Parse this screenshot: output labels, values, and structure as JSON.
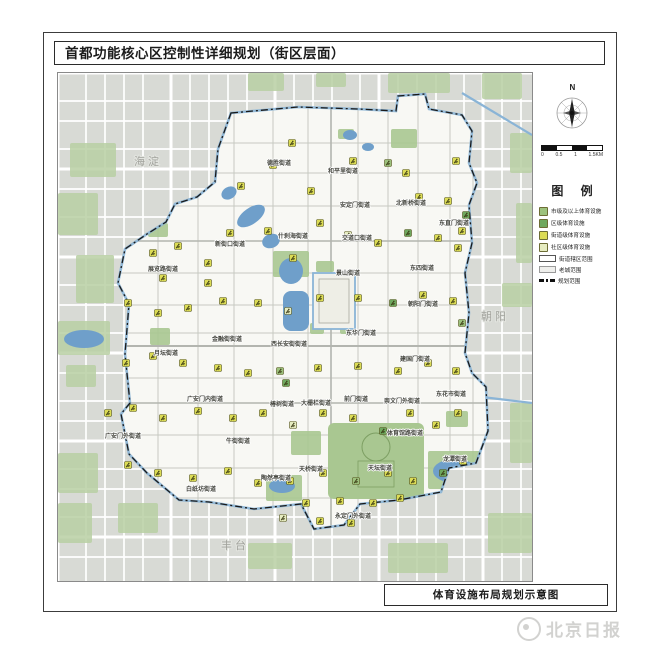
{
  "page": {
    "title": "首都功能核心区控制性详细规划（街区层面）",
    "caption": "体育设施布局规划示意图",
    "watermark": "北京日报"
  },
  "compass": {
    "label": "N"
  },
  "scalebar": {
    "ticks": [
      "0",
      "0.5",
      "1",
      "1.5KM"
    ]
  },
  "legend": {
    "title": "图 例",
    "items": [
      {
        "type": "facility",
        "level": "1",
        "color": "#9dc27d",
        "label": "市级及以上体育设施"
      },
      {
        "type": "facility",
        "level": "2",
        "color": "#6fa85e",
        "label": "区级体育设施"
      },
      {
        "type": "facility",
        "level": "3",
        "color": "#dcdc55",
        "label": "街道级体育设施"
      },
      {
        "type": "facility",
        "level": "4",
        "color": "#e6ecc0",
        "label": "社区级体育设施"
      },
      {
        "type": "rect",
        "label": "街道辖区范围"
      },
      {
        "type": "rect2",
        "label": "老城范围"
      },
      {
        "type": "dash",
        "label": "规划范围"
      }
    ]
  },
  "map": {
    "colors": {
      "level1": "#9dc27d",
      "level2": "#6fa85e",
      "level3": "#dcdc55",
      "level4": "#e6ecc0",
      "water": "#6f9fca",
      "waterline": "#8ab4d6",
      "park": "#a9c791",
      "outside_park": "#b9cfa3",
      "boundary": "#1a1a1a",
      "core_fill": "#f8f8f4"
    },
    "district_labels": [
      {
        "text": "海淀",
        "x": 90,
        "y": 92
      },
      {
        "text": "朝阳",
        "x": 437,
        "y": 247
      },
      {
        "text": "丰台",
        "x": 177,
        "y": 476
      }
    ],
    "street_labels": [
      {
        "text": "德胜街道",
        "x": 221,
        "y": 92
      },
      {
        "text": "和平里街道",
        "x": 285,
        "y": 100
      },
      {
        "text": "安定门街道",
        "x": 297,
        "y": 134
      },
      {
        "text": "北新桥街道",
        "x": 353,
        "y": 132
      },
      {
        "text": "东直门街道",
        "x": 396,
        "y": 152
      },
      {
        "text": "什刹海街道",
        "x": 235,
        "y": 165
      },
      {
        "text": "交道口街道",
        "x": 299,
        "y": 167
      },
      {
        "text": "新街口街道",
        "x": 172,
        "y": 173
      },
      {
        "text": "展览路街道",
        "x": 105,
        "y": 198
      },
      {
        "text": "景山街道",
        "x": 290,
        "y": 202
      },
      {
        "text": "东四街道",
        "x": 364,
        "y": 197
      },
      {
        "text": "朝阳门街道",
        "x": 365,
        "y": 233
      },
      {
        "text": "东华门街道",
        "x": 303,
        "y": 262
      },
      {
        "text": "建国门街道",
        "x": 357,
        "y": 288
      },
      {
        "text": "金融街街道",
        "x": 169,
        "y": 268
      },
      {
        "text": "月坛街道",
        "x": 108,
        "y": 282
      },
      {
        "text": "西长安街街道",
        "x": 231,
        "y": 273
      },
      {
        "text": "广安门内街道",
        "x": 147,
        "y": 328
      },
      {
        "text": "椿树街道",
        "x": 224,
        "y": 333
      },
      {
        "text": "大栅栏街道",
        "x": 258,
        "y": 332
      },
      {
        "text": "前门街道",
        "x": 298,
        "y": 328
      },
      {
        "text": "崇文门外街道",
        "x": 344,
        "y": 330
      },
      {
        "text": "东花市街道",
        "x": 393,
        "y": 323
      },
      {
        "text": "广安门外街道",
        "x": 65,
        "y": 365
      },
      {
        "text": "牛街街道",
        "x": 180,
        "y": 370
      },
      {
        "text": "体育馆路街道",
        "x": 347,
        "y": 362
      },
      {
        "text": "龙潭街道",
        "x": 397,
        "y": 388
      },
      {
        "text": "陶然亭街道",
        "x": 218,
        "y": 407
      },
      {
        "text": "白纸坊街道",
        "x": 143,
        "y": 418
      },
      {
        "text": "天桥街道",
        "x": 253,
        "y": 398
      },
      {
        "text": "天坛街道",
        "x": 322,
        "y": 397
      },
      {
        "text": "永定门外街道",
        "x": 295,
        "y": 445
      }
    ],
    "facilities": [
      {
        "x": 234,
        "y": 70,
        "l": 3
      },
      {
        "x": 215,
        "y": 92,
        "l": 3
      },
      {
        "x": 295,
        "y": 88,
        "l": 3
      },
      {
        "x": 330,
        "y": 90,
        "l": 1
      },
      {
        "x": 348,
        "y": 100,
        "l": 3
      },
      {
        "x": 398,
        "y": 88,
        "l": 3
      },
      {
        "x": 390,
        "y": 128,
        "l": 3
      },
      {
        "x": 361,
        "y": 124,
        "l": 3
      },
      {
        "x": 183,
        "y": 113,
        "l": 3
      },
      {
        "x": 253,
        "y": 118,
        "l": 3
      },
      {
        "x": 408,
        "y": 142,
        "l": 2
      },
      {
        "x": 404,
        "y": 158,
        "l": 3
      },
      {
        "x": 95,
        "y": 180,
        "l": 3
      },
      {
        "x": 120,
        "y": 173,
        "l": 3
      },
      {
        "x": 150,
        "y": 190,
        "l": 3
      },
      {
        "x": 172,
        "y": 160,
        "l": 3
      },
      {
        "x": 210,
        "y": 158,
        "l": 3
      },
      {
        "x": 235,
        "y": 185,
        "l": 3
      },
      {
        "x": 262,
        "y": 150,
        "l": 3
      },
      {
        "x": 290,
        "y": 162,
        "l": 4
      },
      {
        "x": 320,
        "y": 170,
        "l": 3
      },
      {
        "x": 350,
        "y": 160,
        "l": 2
      },
      {
        "x": 380,
        "y": 165,
        "l": 3
      },
      {
        "x": 400,
        "y": 175,
        "l": 3
      },
      {
        "x": 150,
        "y": 210,
        "l": 3
      },
      {
        "x": 105,
        "y": 205,
        "l": 3
      },
      {
        "x": 70,
        "y": 230,
        "l": 3
      },
      {
        "x": 100,
        "y": 240,
        "l": 3
      },
      {
        "x": 130,
        "y": 235,
        "l": 3
      },
      {
        "x": 165,
        "y": 228,
        "l": 3
      },
      {
        "x": 200,
        "y": 230,
        "l": 3
      },
      {
        "x": 230,
        "y": 238,
        "l": 4
      },
      {
        "x": 262,
        "y": 225,
        "l": 3
      },
      {
        "x": 300,
        "y": 225,
        "l": 3
      },
      {
        "x": 335,
        "y": 230,
        "l": 2
      },
      {
        "x": 365,
        "y": 222,
        "l": 3
      },
      {
        "x": 395,
        "y": 228,
        "l": 3
      },
      {
        "x": 404,
        "y": 250,
        "l": 1
      },
      {
        "x": 68,
        "y": 290,
        "l": 3
      },
      {
        "x": 95,
        "y": 283,
        "l": 3
      },
      {
        "x": 125,
        "y": 290,
        "l": 3
      },
      {
        "x": 160,
        "y": 295,
        "l": 3
      },
      {
        "x": 190,
        "y": 300,
        "l": 3
      },
      {
        "x": 222,
        "y": 298,
        "l": 1
      },
      {
        "x": 228,
        "y": 310,
        "l": 2
      },
      {
        "x": 260,
        "y": 295,
        "l": 3
      },
      {
        "x": 300,
        "y": 293,
        "l": 3
      },
      {
        "x": 340,
        "y": 298,
        "l": 3
      },
      {
        "x": 370,
        "y": 290,
        "l": 3
      },
      {
        "x": 398,
        "y": 298,
        "l": 3
      },
      {
        "x": 50,
        "y": 340,
        "l": 3
      },
      {
        "x": 75,
        "y": 335,
        "l": 3
      },
      {
        "x": 105,
        "y": 345,
        "l": 3
      },
      {
        "x": 140,
        "y": 338,
        "l": 3
      },
      {
        "x": 175,
        "y": 345,
        "l": 3
      },
      {
        "x": 205,
        "y": 340,
        "l": 3
      },
      {
        "x": 235,
        "y": 352,
        "l": 4
      },
      {
        "x": 265,
        "y": 340,
        "l": 3
      },
      {
        "x": 295,
        "y": 345,
        "l": 3
      },
      {
        "x": 325,
        "y": 358,
        "l": 2
      },
      {
        "x": 352,
        "y": 340,
        "l": 3
      },
      {
        "x": 378,
        "y": 352,
        "l": 3
      },
      {
        "x": 400,
        "y": 340,
        "l": 3
      },
      {
        "x": 70,
        "y": 392,
        "l": 3
      },
      {
        "x": 100,
        "y": 400,
        "l": 3
      },
      {
        "x": 135,
        "y": 405,
        "l": 3
      },
      {
        "x": 170,
        "y": 398,
        "l": 3
      },
      {
        "x": 200,
        "y": 410,
        "l": 3
      },
      {
        "x": 232,
        "y": 408,
        "l": 3
      },
      {
        "x": 265,
        "y": 400,
        "l": 3
      },
      {
        "x": 298,
        "y": 408,
        "l": 1
      },
      {
        "x": 330,
        "y": 400,
        "l": 3
      },
      {
        "x": 355,
        "y": 408,
        "l": 3
      },
      {
        "x": 385,
        "y": 400,
        "l": 2
      },
      {
        "x": 405,
        "y": 388,
        "l": 3
      },
      {
        "x": 248,
        "y": 430,
        "l": 3
      },
      {
        "x": 282,
        "y": 428,
        "l": 3
      },
      {
        "x": 315,
        "y": 430,
        "l": 3
      },
      {
        "x": 342,
        "y": 425,
        "l": 3
      },
      {
        "x": 225,
        "y": 445,
        "l": 4
      },
      {
        "x": 262,
        "y": 448,
        "l": 3
      },
      {
        "x": 293,
        "y": 450,
        "l": 3
      }
    ]
  }
}
